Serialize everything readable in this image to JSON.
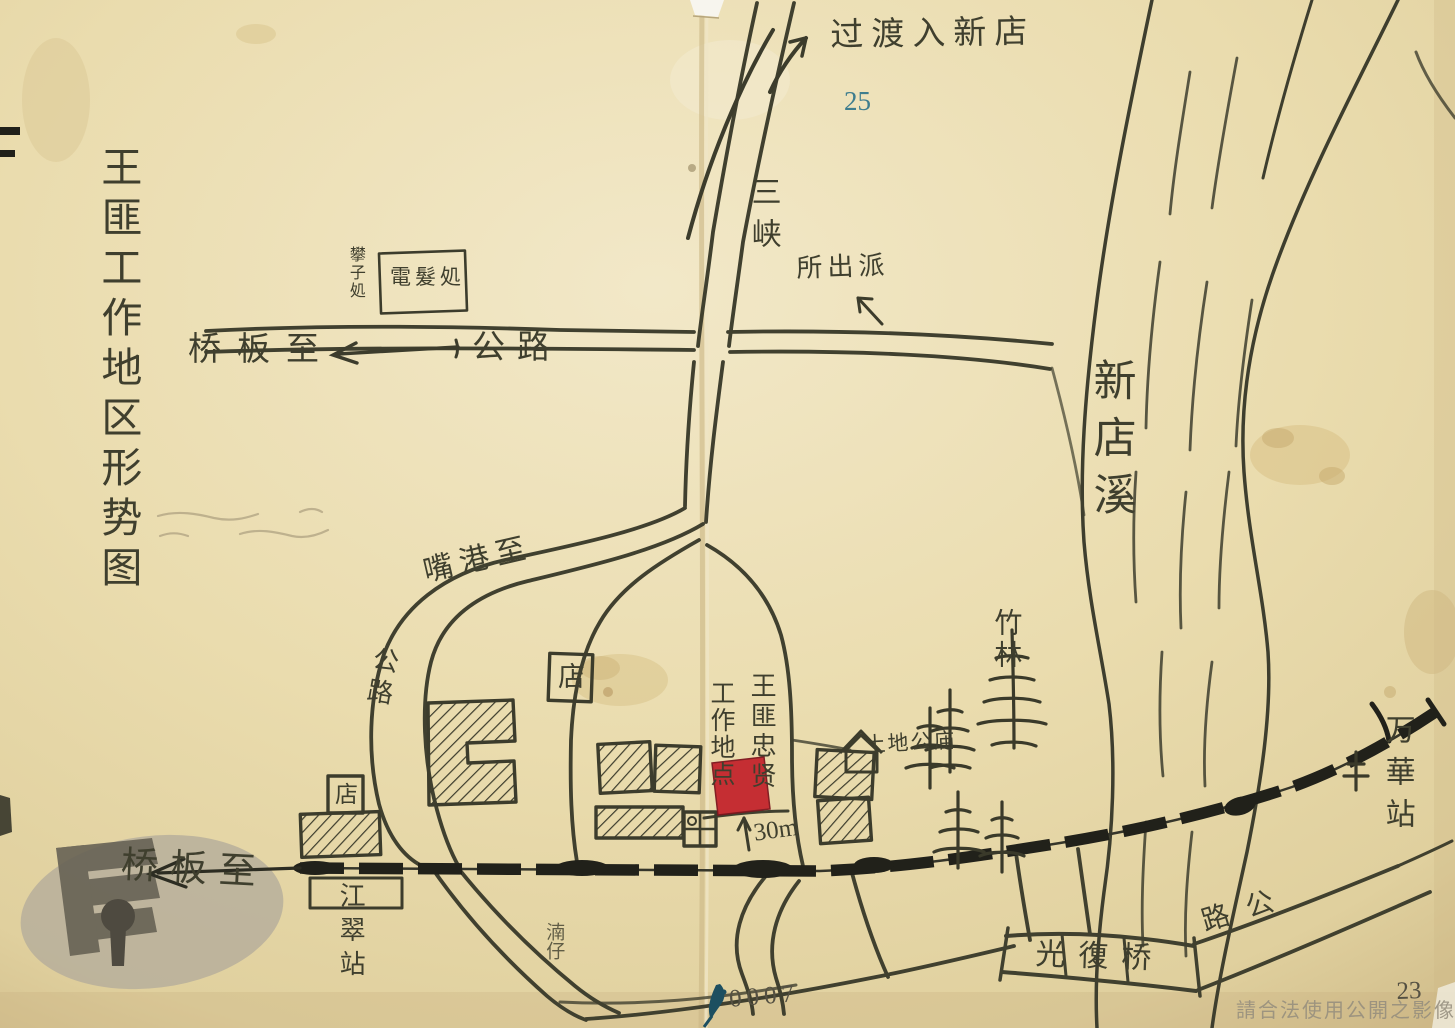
{
  "document": {
    "title": "王匪工作地区形势图"
  },
  "labels": {
    "route_to_xindian": "过渡入新店",
    "sanxia": "三峡",
    "police_station": "所出派",
    "perm_shop_box": "電髮処",
    "perm_shop_side": "攀子処",
    "to_banqiao_highway": "桥板至",
    "highway_west": "公路",
    "xindian_creek": "新店溪",
    "to_gangzui": "嘴港至",
    "highway_loop": "公路",
    "shop_upper": "店",
    "shop_lower": "店",
    "target_name_column": "王匪忠贤",
    "target_site_column": "工作地点",
    "distance_30m": "30m",
    "bamboo_grove": "竹林",
    "earth_god_temple": "土地公庙",
    "nanzi": "湳仔",
    "jiangcui_station": "江翠站",
    "to_banqiao_railway": "桥板至",
    "wanhua_station": "万華站",
    "guangfu_bridge": "光復桥",
    "highway_bridge": "路公"
  },
  "numbers": {
    "blue_page_number": "25",
    "archive_number": "0007",
    "corner_number": "23"
  },
  "watermark": {
    "usage_notice": "請合法使用公開之影像"
  },
  "colors": {
    "paper": "#eadcae",
    "ink": "#40402f",
    "railway_black": "#21211a",
    "marker_red": "#c4252d",
    "number_blue": "#3e7d8e",
    "watermark_gray": "#948d7d"
  }
}
